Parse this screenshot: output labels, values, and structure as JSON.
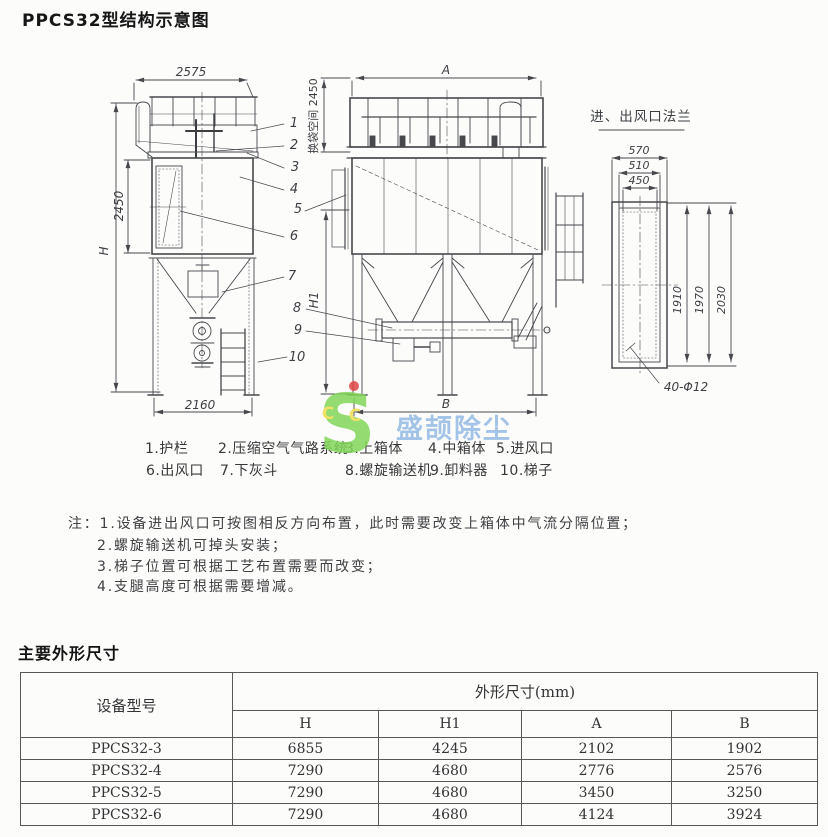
{
  "page": {
    "title": "PPCS32型结构示意图",
    "section2_title": "主要外形尺寸"
  },
  "diagram": {
    "flange_title": "进、出风口法兰",
    "dims": {
      "top_width": "2575",
      "overall_height": "H",
      "body_height": "2450",
      "bag_space": "换袋空间 2450",
      "base_width": "2160",
      "front_width": "A",
      "front_base": "B",
      "hopper_height": "H1",
      "flange_w1": "570",
      "flange_w2": "510",
      "flange_w3": "450",
      "flange_h1": "1910",
      "flange_h2": "1970",
      "flange_h3": "2030",
      "bolt_note": "40-Φ12"
    },
    "callouts": [
      "1",
      "2",
      "3",
      "4",
      "5",
      "6",
      "7",
      "8",
      "9",
      "10"
    ],
    "legend_row1": [
      "1.护栏",
      "2.压缩空气气路系统",
      "3.上箱体",
      "4.中箱体",
      "5.进风口"
    ],
    "legend_row2": [
      "6.出风口",
      "7.下灰斗",
      "8.螺旋输送机",
      "9.卸料器",
      "10.梯子"
    ]
  },
  "notes": {
    "prefix": "注：",
    "items": [
      "1.设备进出风口可按图相反方向布置，此时需要改变上箱体中气流分隔位置；",
      "2.螺旋输送机可掉头安装；",
      "3.梯子位置可根据工艺布置需要而改变；",
      "4.支腿高度可根据需要增减。"
    ]
  },
  "watermark": {
    "logo_letter": "S",
    "logo_c1": "C",
    "logo_c2": "C",
    "brand": "盛颉除尘",
    "green": "#82d75a",
    "yellow": "#f0dd4a",
    "red": "#e04545",
    "blue": "#7aabdf"
  },
  "table": {
    "col1_header": "设备型号",
    "group_header": "外形尺寸(mm)",
    "sub_headers": [
      "H",
      "H1",
      "A",
      "B"
    ],
    "rows": [
      {
        "model": "PPCS32-3",
        "H": "6855",
        "H1": "4245",
        "A": "2102",
        "B": "1902"
      },
      {
        "model": "PPCS32-4",
        "H": "7290",
        "H1": "4680",
        "A": "2776",
        "B": "2576"
      },
      {
        "model": "PPCS32-5",
        "H": "7290",
        "H1": "4680",
        "A": "3450",
        "B": "3250"
      },
      {
        "model": "PPCS32-6",
        "H": "7290",
        "H1": "4680",
        "A": "4124",
        "B": "3924"
      }
    ]
  }
}
